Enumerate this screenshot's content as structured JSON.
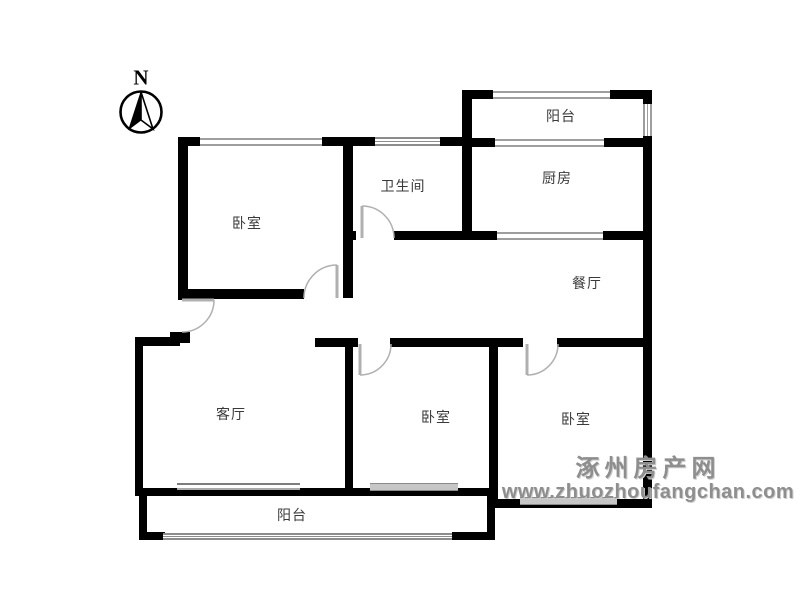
{
  "compass": {
    "label": "N"
  },
  "rooms": {
    "balcony_top": {
      "label": "阳台"
    },
    "kitchen": {
      "label": "厨房"
    },
    "bathroom": {
      "label": "卫生间"
    },
    "bedroom_top_left": {
      "label": "卧室"
    },
    "dining": {
      "label": "餐厅"
    },
    "living": {
      "label": "客厅"
    },
    "bedroom_bottom_middle": {
      "label": "卧室"
    },
    "bedroom_bottom_right": {
      "label": "卧室"
    },
    "balcony_bottom": {
      "label": "阳台"
    }
  },
  "watermark": {
    "site_name": "涿州房产网",
    "site_url": "www.zhuozhoufangchan.com"
  },
  "colors": {
    "wall": "#000000",
    "window_line": "#9e9e9e",
    "door": "#b0b0b0",
    "label_text": "#3a3a3a",
    "watermark": "#8e8e8e"
  }
}
